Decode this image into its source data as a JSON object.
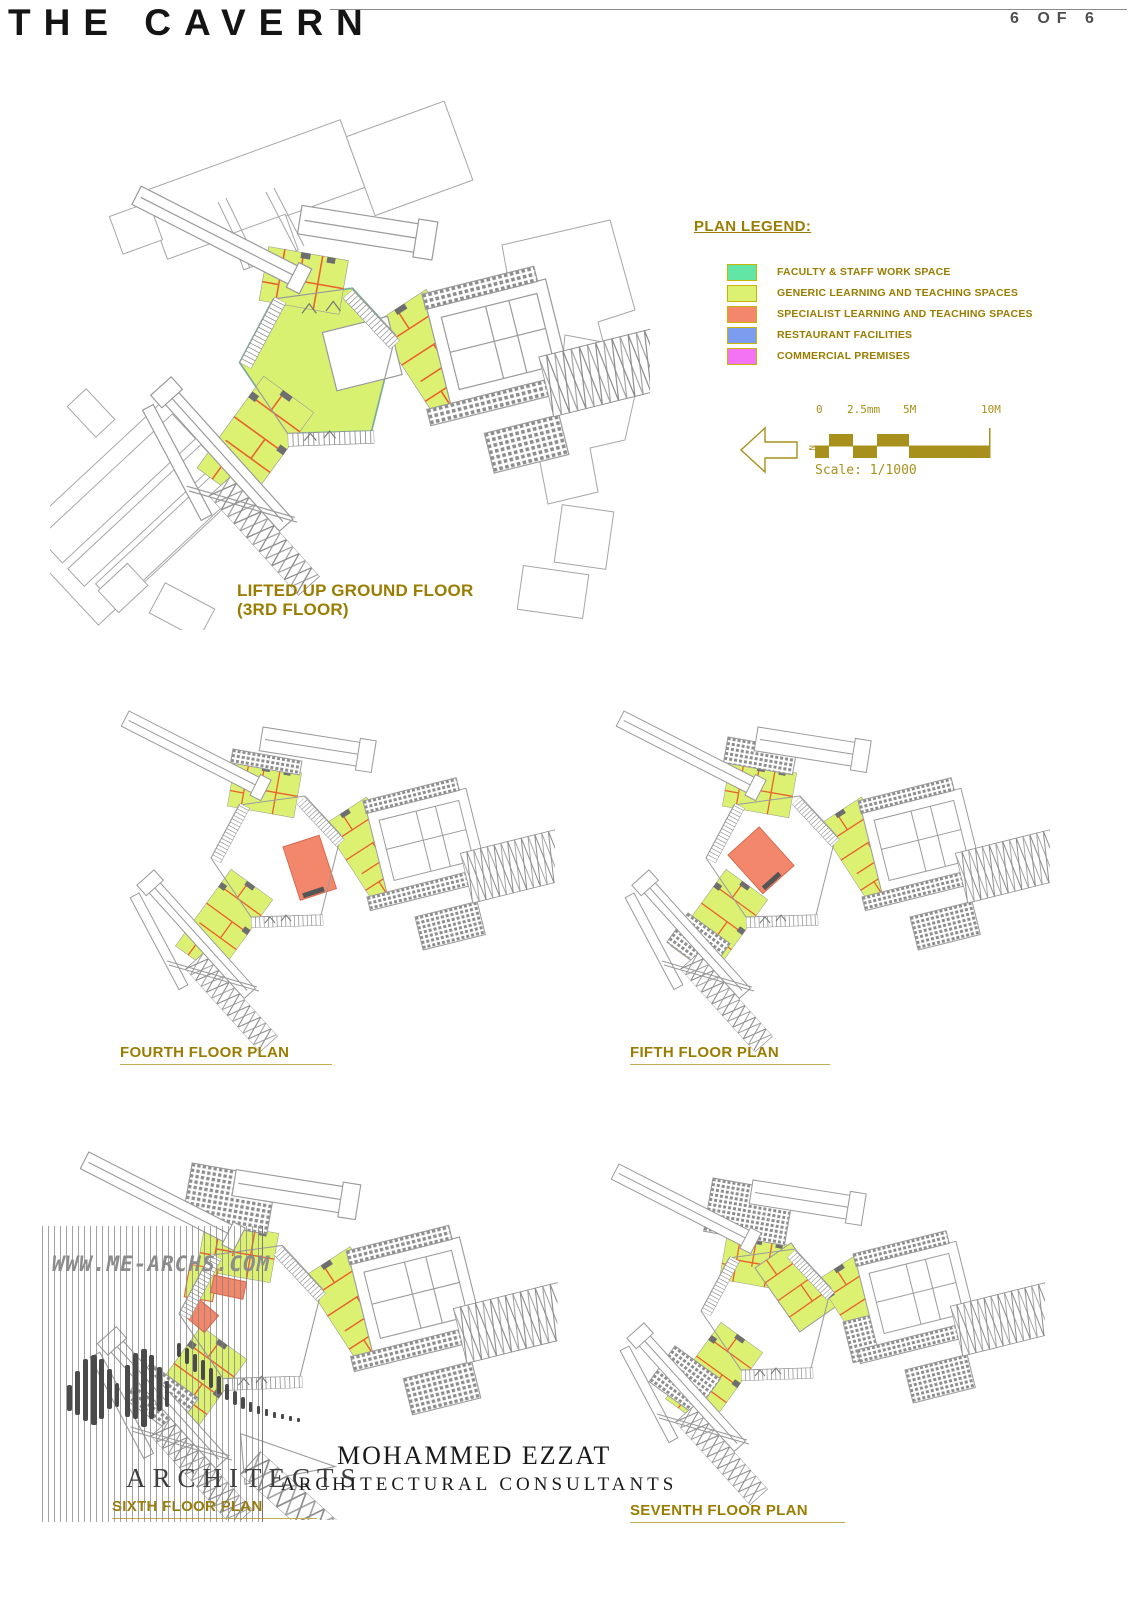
{
  "header": {
    "title": "THE CAVERN",
    "page": "6 OF 6"
  },
  "legend": {
    "title": "PLAN LEGEND:",
    "items": [
      {
        "label": "FACULTY & STAFF WORK SPACE",
        "color": "#63e6a5"
      },
      {
        "label": "GENERIC LEARNING AND TEACHING SPACES",
        "color": "#dcf171"
      },
      {
        "label": "SPECIALIST LEARNING AND TEACHING SPACES",
        "color": "#f2876b"
      },
      {
        "label": "RESTAURANT FACILITIES",
        "color": "#7c9cf0"
      },
      {
        "label": "COMMERCIAL PREMISES",
        "color": "#f473f4"
      }
    ]
  },
  "scale_bar": {
    "ticks": [
      "0",
      "2.5mm",
      "5M",
      "10M"
    ],
    "scale_label": "Scale: 1/1000",
    "north_label": "N"
  },
  "plans": {
    "main": {
      "line1": "LIFTED UP GROUND FLOOR",
      "line2": "(3RD FLOOR)"
    },
    "fourth": {
      "title": "FOURTH FLOOR PLAN"
    },
    "fifth": {
      "title": "FIFTH FLOOR PLAN"
    },
    "sixth": {
      "title": "SIXTH FLOOR PLAN"
    },
    "seventh": {
      "title": "SEVENTH FLOOR PLAN"
    }
  },
  "watermark": {
    "url": "WWW.ME-ARCHS.COM",
    "firm": "ARCHITECTS",
    "name": "MOHAMMED EZZAT",
    "subtitle": "ARCHITECTURAL CONSULTANTS"
  },
  "colors": {
    "accent_olive": "#9a7d00",
    "linework_gray": "#9a9a9a",
    "partition_orange": "#e8612c"
  }
}
